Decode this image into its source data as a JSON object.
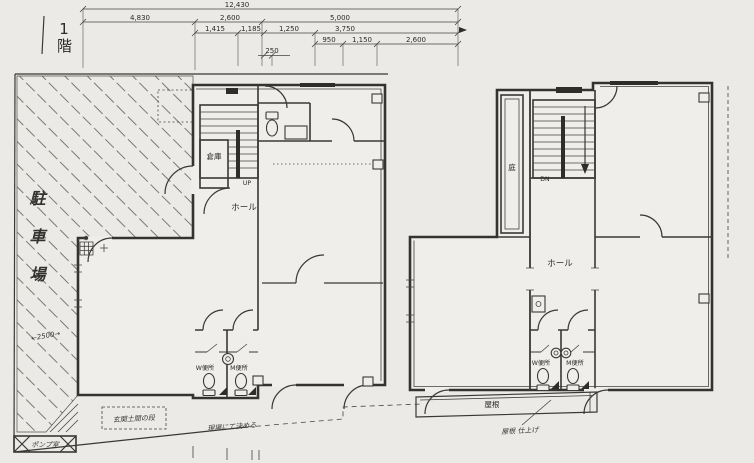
{
  "drawing": {
    "floor_label": "1階",
    "dims": {
      "total": "12,430",
      "r2": [
        "4,830",
        "2,600",
        "5,000"
      ],
      "r3": [
        "1,415",
        "1,185",
        "1,250",
        "3,750"
      ],
      "r4": [
        "950",
        "1,150",
        "2,600"
      ],
      "r5": "250"
    },
    "f1": {
      "storage": "倉庫",
      "up": "UP",
      "hall": "ホール",
      "wc_w": "W便所",
      "wc_m": "M便所",
      "parking": "駐車場",
      "parking_dim": "←2500→",
      "pump_room": "ポンプ室",
      "note_entry": "玄関土間の段",
      "note_site": "現場にて決める"
    },
    "f2": {
      "court": "庭",
      "dn": "DN",
      "hall": "ホール",
      "wc_w": "W便所",
      "wc_m": "M便所",
      "roof": "屋根",
      "note_roof": "屋根 仕上げ"
    }
  }
}
